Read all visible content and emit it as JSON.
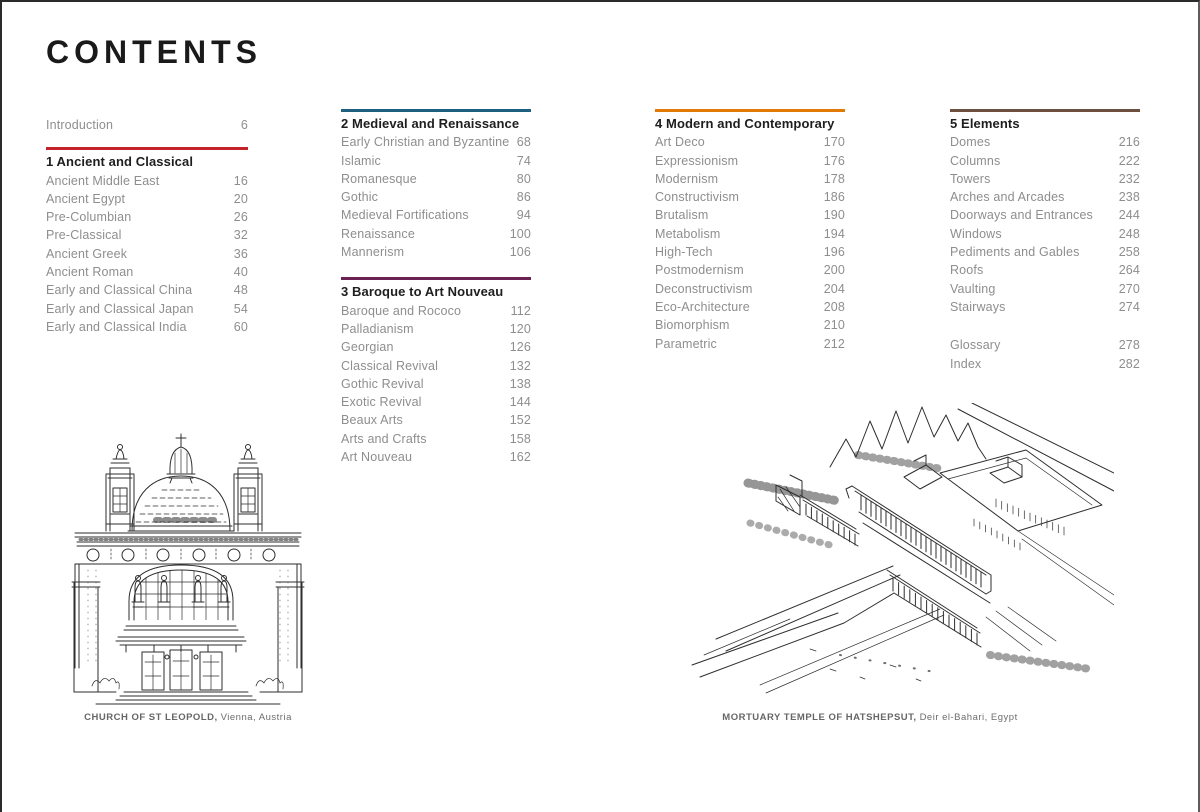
{
  "title": "CONTENTS",
  "colors": {
    "accent_red": "#c4232b",
    "accent_blue": "#1f5f80",
    "accent_plum": "#6b2152",
    "accent_orange": "#e07a04",
    "accent_brown": "#6d4f40",
    "heading_text": "#1e1e1e",
    "entry_text": "#8e8e8e",
    "caption_text": "#6d6d6d"
  },
  "columns": [
    {
      "intro": {
        "label": "Introduction",
        "page": "6"
      },
      "sections": [
        {
          "title": "1 Ancient and Classical",
          "accent": "#c4232b",
          "entries": [
            {
              "label": "Ancient Middle East",
              "page": "16"
            },
            {
              "label": "Ancient Egypt",
              "page": "20"
            },
            {
              "label": "Pre-Columbian",
              "page": "26"
            },
            {
              "label": "Pre-Classical",
              "page": "32"
            },
            {
              "label": "Ancient Greek",
              "page": "36"
            },
            {
              "label": "Ancient Roman",
              "page": "40"
            },
            {
              "label": "Early and Classical China",
              "page": "48"
            },
            {
              "label": "Early and Classical Japan",
              "page": "54"
            },
            {
              "label": "Early and Classical India",
              "page": "60"
            }
          ]
        }
      ]
    },
    {
      "sections": [
        {
          "title": "2 Medieval and Renaissance",
          "accent": "#1f5f80",
          "entries": [
            {
              "label": "Early Christian and Byzantine",
              "page": "68"
            },
            {
              "label": "Islamic",
              "page": "74"
            },
            {
              "label": "Romanesque",
              "page": "80"
            },
            {
              "label": "Gothic",
              "page": "86"
            },
            {
              "label": "Medieval Fortifications",
              "page": "94"
            },
            {
              "label": "Renaissance",
              "page": "100"
            },
            {
              "label": "Mannerism",
              "page": "106"
            }
          ]
        },
        {
          "title": "3 Baroque to Art Nouveau",
          "accent": "#6b2152",
          "entries": [
            {
              "label": "Baroque and Rococo",
              "page": "112"
            },
            {
              "label": "Palladianism",
              "page": "120"
            },
            {
              "label": "Georgian",
              "page": "126"
            },
            {
              "label": "Classical Revival",
              "page": "132"
            },
            {
              "label": "Gothic Revival",
              "page": "138"
            },
            {
              "label": "Exotic Revival",
              "page": "144"
            },
            {
              "label": "Beaux Arts",
              "page": "152"
            },
            {
              "label": "Arts and Crafts",
              "page": "158"
            },
            {
              "label": "Art Nouveau",
              "page": "162"
            }
          ]
        }
      ]
    },
    {
      "sections": [
        {
          "title": "4 Modern and Contemporary",
          "accent": "#e07a04",
          "entries": [
            {
              "label": "Art Deco",
              "page": "170"
            },
            {
              "label": "Expressionism",
              "page": "176"
            },
            {
              "label": "Modernism",
              "page": "178"
            },
            {
              "label": "Constructivism",
              "page": "186"
            },
            {
              "label": "Brutalism",
              "page": "190"
            },
            {
              "label": "Metabolism",
              "page": "194"
            },
            {
              "label": "High-Tech",
              "page": "196"
            },
            {
              "label": "Postmodernism",
              "page": "200"
            },
            {
              "label": "Deconstructivism",
              "page": "204"
            },
            {
              "label": "Eco-Architecture",
              "page": "208"
            },
            {
              "label": "Biomorphism",
              "page": "210"
            },
            {
              "label": "Parametric",
              "page": "212"
            }
          ]
        }
      ]
    },
    {
      "sections": [
        {
          "title": "5 Elements",
          "accent": "#6d4f40",
          "entries": [
            {
              "label": "Domes",
              "page": "216"
            },
            {
              "label": "Columns",
              "page": "222"
            },
            {
              "label": "Towers",
              "page": "232"
            },
            {
              "label": "Arches and Arcades",
              "page": "238"
            },
            {
              "label": "Doorways and Entrances",
              "page": "244"
            },
            {
              "label": "Windows",
              "page": "248"
            },
            {
              "label": "Pediments and Gables",
              "page": "258"
            },
            {
              "label": "Roofs",
              "page": "264"
            },
            {
              "label": "Vaulting",
              "page": "270"
            },
            {
              "label": "Stairways",
              "page": "274"
            }
          ]
        }
      ],
      "backmatter": [
        {
          "label": "Glossary",
          "page": "278"
        },
        {
          "label": "Index",
          "page": "282"
        }
      ]
    }
  ],
  "illustrations": [
    {
      "name": "church-of-st-leopold",
      "caption_title": "CHURCH OF ST LEOPOLD,",
      "caption_location": "Vienna, Austria"
    },
    {
      "name": "mortuary-temple-of-hatshepsut",
      "caption_title": "MORTUARY TEMPLE OF HATSHEPSUT,",
      "caption_location": "Deir el-Bahari, Egypt"
    }
  ]
}
